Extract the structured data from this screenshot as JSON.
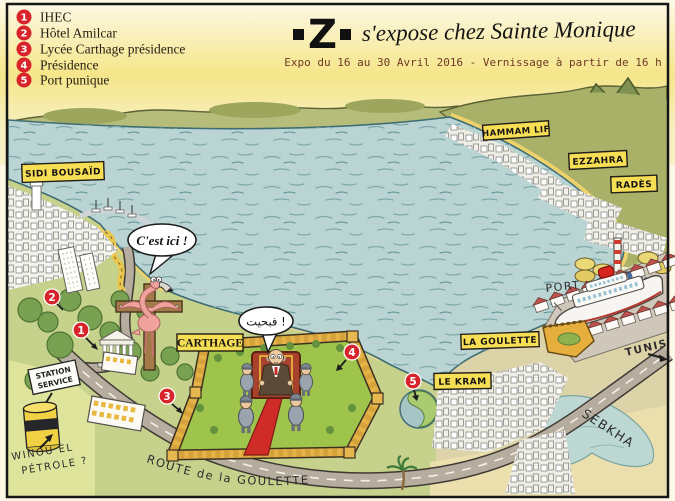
{
  "header": {
    "logo_text": "Z",
    "title_script": "s'expose chez Sainte Monique",
    "subtitle": "Expo du 16 au 30 Avril 2016 - Vernissage à partir de 16 h"
  },
  "legend": {
    "items": [
      {
        "num": "1",
        "label": "IHEC"
      },
      {
        "num": "2",
        "label": "Hôtel Amilcar"
      },
      {
        "num": "3",
        "label": "Lycée Carthage présidence"
      },
      {
        "num": "4",
        "label": "Présidence"
      },
      {
        "num": "5",
        "label": "Port punique"
      }
    ]
  },
  "map": {
    "towns": {
      "sidi_bousaid": "SIDI BOUSAÏD",
      "hammam_lif": "HAMMAM LIF",
      "ezzahra": "EZZAHRA",
      "rades": "RADÈS",
      "carthage": "CARTHAGE",
      "la_goulette": "LA GOULETTE",
      "le_kram": "LE KRAM"
    },
    "handwritten": {
      "port": "PORT",
      "tunis": "TUNIS",
      "sebkha": "SEBKHA",
      "route_goulette": "ROUTE de la GOULETTE",
      "station_line1": "STATION",
      "station_line2": "SERVICE",
      "winou_line1": "WINOU EL",
      "winou_line2": "PÉTROLE ?"
    },
    "speech_bubbles": {
      "flamingo": "C'est ici !",
      "president": "فبحيت !"
    },
    "markers": [
      {
        "num": "1"
      },
      {
        "num": "2"
      },
      {
        "num": "3"
      },
      {
        "num": "4"
      },
      {
        "num": "5"
      }
    ]
  },
  "colors": {
    "marker_red": "#d8232a",
    "label_yellow": "#f6df55",
    "sea": "#bad4d3",
    "subtitle_brown": "#6e3a22"
  }
}
